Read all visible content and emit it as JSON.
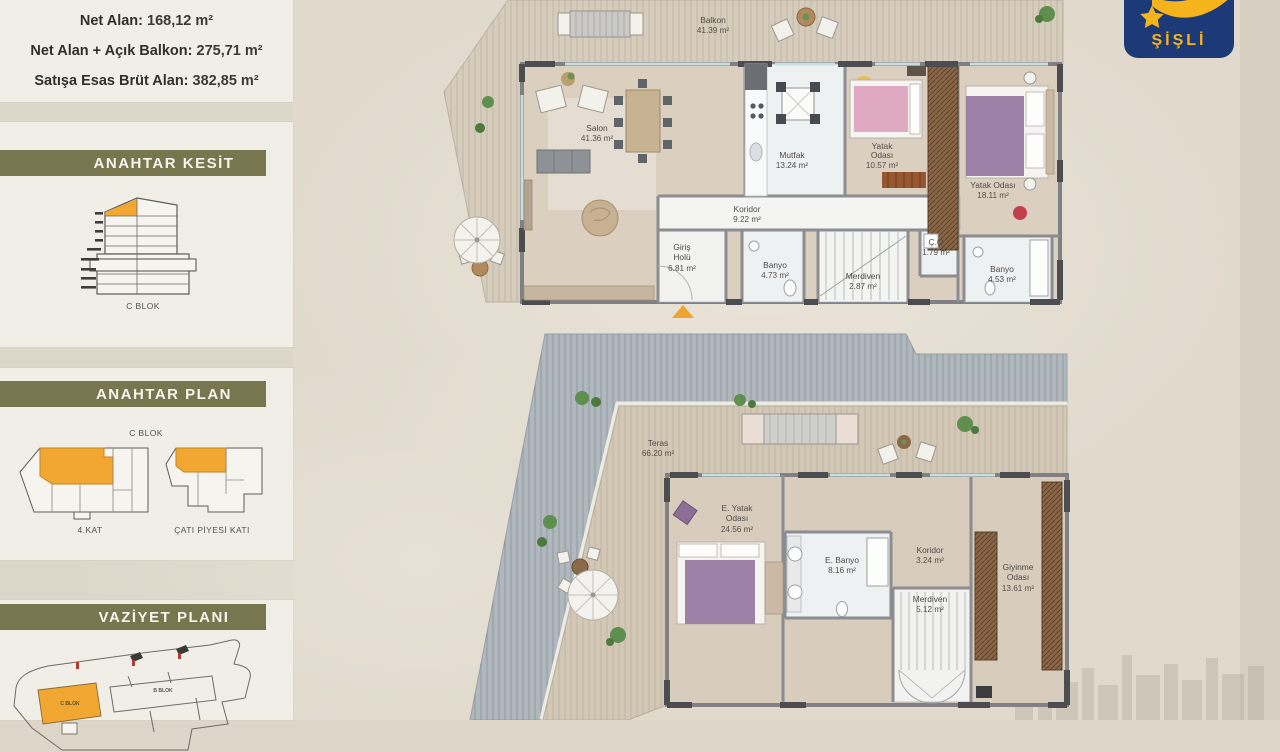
{
  "colors": {
    "accent_orange": "#F0A32E",
    "olive_header": "#77764E",
    "logo_navy": "#1D3A78",
    "logo_yellow": "#F6B41C"
  },
  "summary": {
    "lines": [
      {
        "label": "Net Alan:",
        "value": "168,12 m²"
      },
      {
        "label": "Net Alan + Açık Balkon:",
        "value": "275,71 m²"
      },
      {
        "label": "Satışa Esas Brüt Alan:",
        "value": "382,85 m²"
      }
    ]
  },
  "sidebar": {
    "kesit": {
      "title": "ANAHTAR KESİT",
      "caption": "C BLOK"
    },
    "plan": {
      "title": "ANAHTAR PLAN",
      "caption": "C BLOK",
      "left_caption": "4.KAT",
      "right_caption": "ÇATI PİYESİ KATI"
    },
    "vaziyet": {
      "title": "VAZİYET PLANI",
      "c_blok": "C BLOK",
      "b_blok": "B BLOK"
    }
  },
  "logo": {
    "text": "ŞİŞLİ"
  },
  "upper_plan": {
    "rooms": {
      "balkon": {
        "lines": [
          "Balkon"
        ],
        "area": "41.39 m²"
      },
      "salon": {
        "lines": [
          "Salon"
        ],
        "area": "41.36 m²"
      },
      "mutfak": {
        "lines": [
          "Mutfak"
        ],
        "area": "13.24 m²"
      },
      "yatak1": {
        "lines": [
          "Yatak",
          "Odası"
        ],
        "area": "10.57 m²"
      },
      "yatak2": {
        "lines": [
          "Yatak Odası"
        ],
        "area": "18.11 m²"
      },
      "koridor": {
        "lines": [
          "Koridor"
        ],
        "area": "9.22 m²"
      },
      "giris": {
        "lines": [
          "Giriş",
          "Holü"
        ],
        "area": "6.81 m²"
      },
      "banyo1": {
        "lines": [
          "Banyo"
        ],
        "area": "4.73 m²"
      },
      "merdiven": {
        "lines": [
          "Merdiven"
        ],
        "area": "2.87 m²"
      },
      "co": {
        "lines": [
          "Ç.O"
        ],
        "area": "1.79 m²"
      },
      "banyo2": {
        "lines": [
          "Banyo"
        ],
        "area": "4.53 m²"
      }
    }
  },
  "lower_plan": {
    "rooms": {
      "teras": {
        "lines": [
          "Teras"
        ],
        "area": "66.20 m²"
      },
      "eyatak": {
        "lines": [
          "E. Yatak",
          "Odası"
        ],
        "area": "24.56 m²"
      },
      "ebanyo": {
        "lines": [
          "E. Banyo"
        ],
        "area": "8.16 m²"
      },
      "koridor": {
        "lines": [
          "Koridor"
        ],
        "area": "3.24 m²"
      },
      "merdiven": {
        "lines": [
          "Merdiven"
        ],
        "area": "5.12 m²"
      },
      "giyinme": {
        "lines": [
          "Giyinme",
          "Odası"
        ],
        "area": "13.61 m²"
      }
    }
  }
}
